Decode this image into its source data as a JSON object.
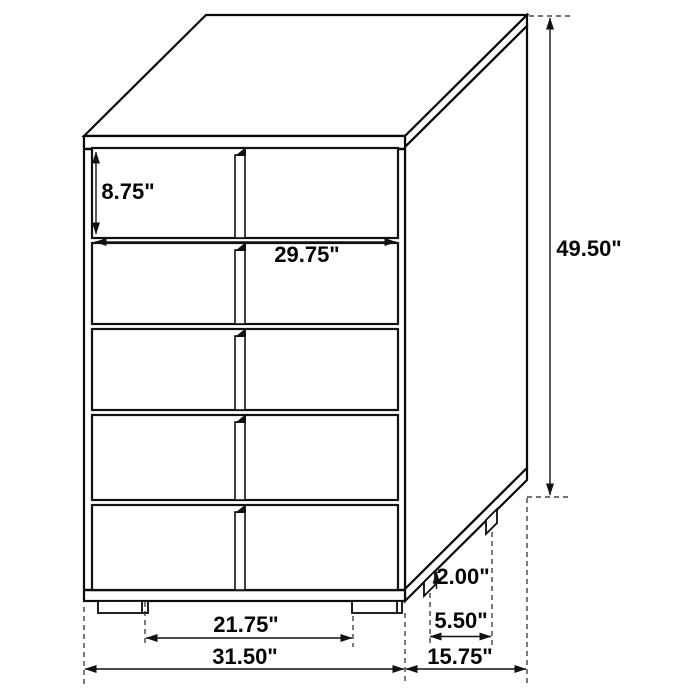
{
  "figure": {
    "kind": "furniture-dimension-diagram",
    "line_color": "#0a0a0a",
    "background_color": "#ffffff",
    "drawer_count": 5
  },
  "labels": {
    "drawer_height": "8.75\"",
    "drawer_width": "29.75\"",
    "overall_height": "49.50\"",
    "leg_height": "2.00\"",
    "side_leg_spacing": "5.50\"",
    "front_leg_spacing": "21.75\"",
    "overall_width": "31.50\"",
    "overall_depth": "15.75\""
  }
}
